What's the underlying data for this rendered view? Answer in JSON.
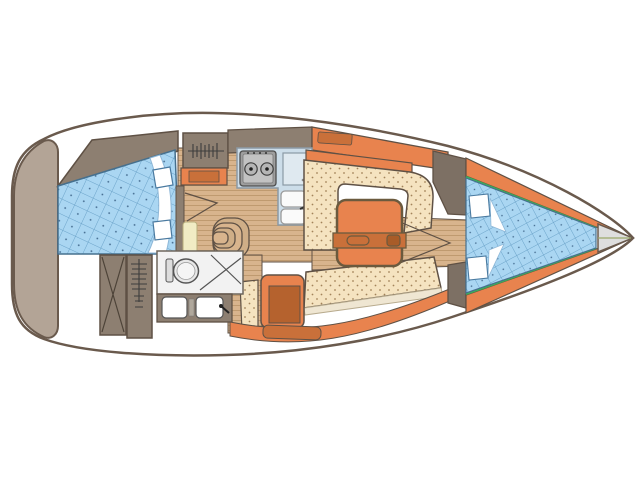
{
  "meta": {
    "title": "Sailing yacht interior layout — top-down floor plan",
    "view": "deck plan, bow pointing right",
    "canvas": {
      "width": 640,
      "height": 480
    }
  },
  "palette": {
    "hull_line": "#6a5a4d",
    "furniture_line": "#5f5145",
    "taupe": "#8d7f71",
    "taupe_light": "#b3a496",
    "taupe_dark": "#7d7064",
    "orange": "#e8834e",
    "orange_dark": "#c9703a",
    "orange_deep": "#b5622e",
    "wood": "#d8b48d",
    "wood_stripe": "#bf9a6f",
    "cushion": "#f5e3c0",
    "cushion_dot": "#a3835a",
    "mattress": "#aad6f2",
    "mattress_grid": "#6ba3c9",
    "mattress_edge": "#46708e",
    "counter": "#ccdde9",
    "appliance": "#9e9e9e",
    "floor_head": "#f2f2f2",
    "trim_green": "#3cae5b",
    "anchor_locker": "#dedede",
    "background": "#ffffff"
  },
  "areas": {
    "boat": {
      "label": "Sailboat interior layout plan"
    },
    "stern": {
      "label": "Stern transom"
    },
    "aft_cabin": {
      "label": "Aft double cabin",
      "berth": "Double berth with quilted mattress",
      "pillows": 2,
      "wardrobe": "Hanging locker with clothes rail"
    },
    "storage": {
      "label": "Aft storage lockers",
      "features": [
        "Cross-braced locker",
        "Vertical hanging locker"
      ]
    },
    "galley": {
      "label": "Galley",
      "stove_burners": 2,
      "sinks": 2,
      "features": [
        "Two-burner stove",
        "Worktop / icebox",
        "Double sink with faucet"
      ]
    },
    "companionway": {
      "label": "Companionway steps",
      "steps": 4
    },
    "head": {
      "label": "Head (bathroom)",
      "features": [
        "Marine toilet",
        "Shower corner",
        "Twin washbasin vanity"
      ]
    },
    "salon": {
      "label": "Salon",
      "settee": "U-shaped upholstered settee",
      "opposite": "Straight starboard settee",
      "table": "Folding salon table"
    },
    "nav_seat": {
      "label": "Seat with cushion"
    },
    "fore_cabin": {
      "label": "Forward V-berth cabin",
      "berth": "V-berth with quilted mattress",
      "pillows": 2,
      "trim": "Green piping along hull liner"
    },
    "bow": {
      "label": "Anchor locker"
    }
  }
}
